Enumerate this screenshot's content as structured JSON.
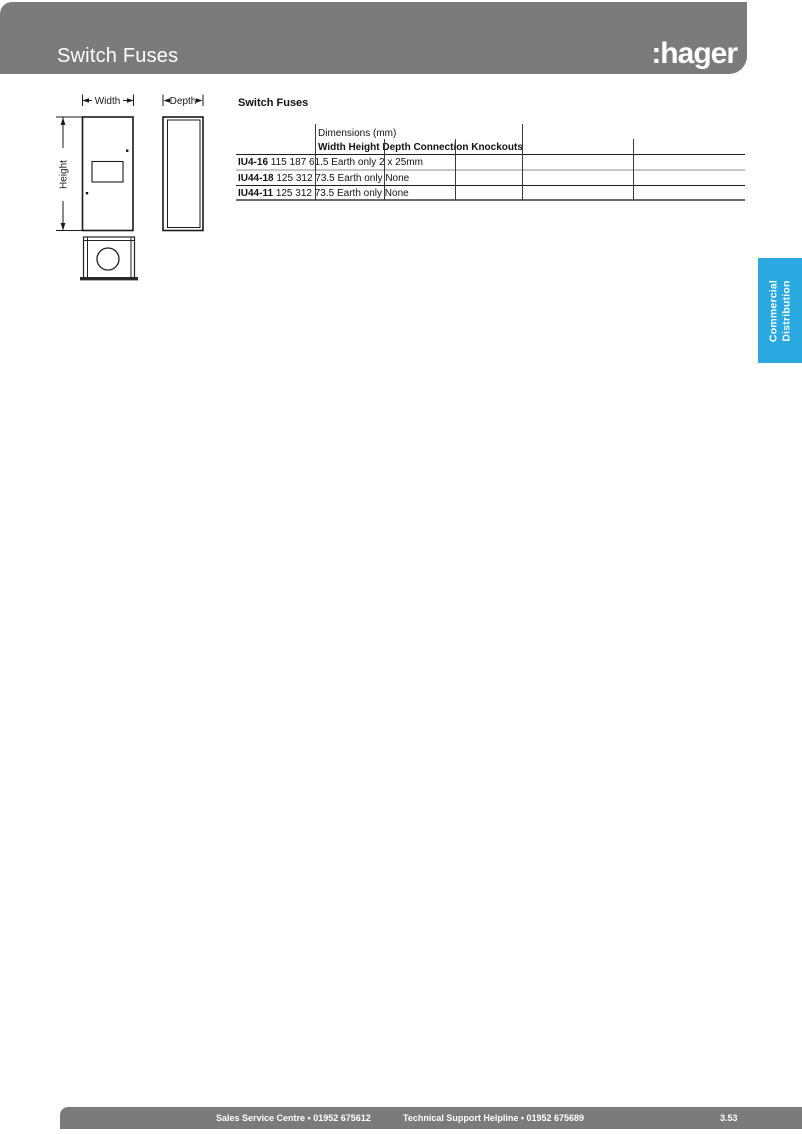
{
  "header": {
    "title": "Switch Fuses",
    "logo": ":hager"
  },
  "diagram": {
    "width_label": "Width",
    "height_label": "Height",
    "depth_label": "Depth"
  },
  "table": {
    "caption": "Switch Fuses",
    "dimensions_label": "Dimensions (mm)",
    "columns": [
      "Width",
      "Height",
      "Depth",
      "Connection",
      "Knockouts"
    ],
    "rows": [
      {
        "model": "IU4-16",
        "values": [
          "115",
          "187",
          "61.5",
          "Earth only",
          "2 x 25mm"
        ]
      },
      {
        "model": "IU44-18",
        "values": [
          "125",
          "312",
          "73.5",
          "Earth only",
          "None"
        ]
      },
      {
        "model": "IU44-11",
        "values": [
          "125",
          "312",
          "73.5",
          "Earth only",
          "None"
        ]
      }
    ]
  },
  "side_tab": {
    "line1": "Commercial",
    "line2": "Distribution"
  },
  "footer": {
    "sales": "Sales Service Centre • 01952 675612",
    "support": "Technical Support Helpline • 01952 675689",
    "page_number": "3.53"
  },
  "colors": {
    "bar_gray": "#7b7b7b",
    "tab_blue": "#29a9e0",
    "line_light": "#c5c5c5",
    "line_dark": "#6a6a6a"
  }
}
